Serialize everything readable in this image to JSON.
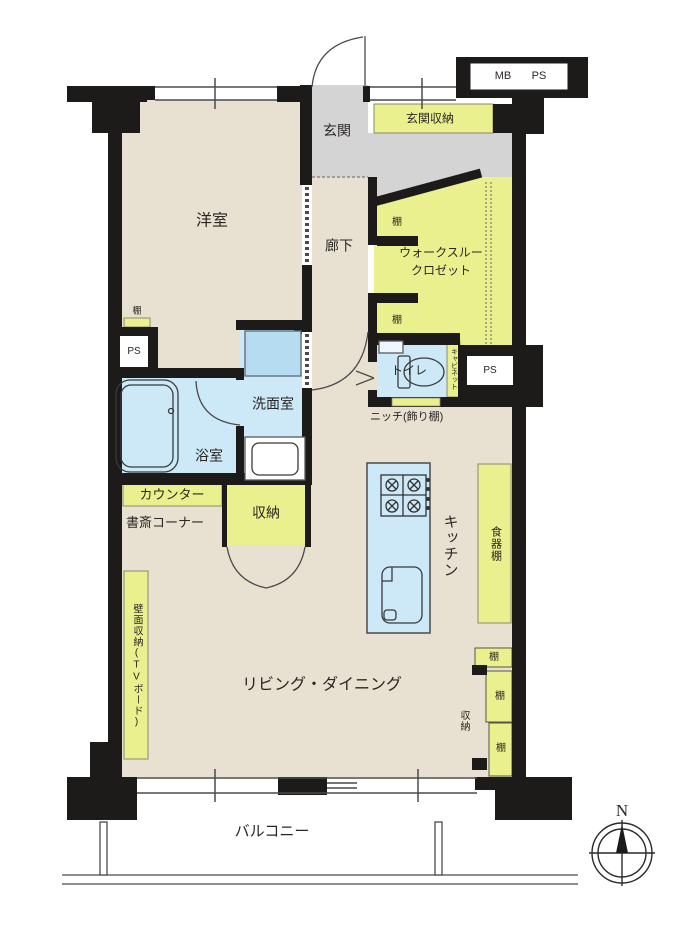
{
  "plan": {
    "rooms": {
      "western_room": "洋室",
      "entrance": "玄関",
      "hallway": "廊下",
      "walk_through_closet": [
        "ウォークスルー",
        "クロゼット"
      ],
      "toilet": "トイレ",
      "washroom": "洗面室",
      "bathroom": "浴室",
      "kitchen": "キッチン",
      "living_dining": "リビング・ダイニング",
      "balcony": "バルコニー"
    },
    "storage": {
      "entrance_storage": "玄関収納",
      "shelf": "棚",
      "cabinet": "キャビネット",
      "niche": "ニッチ(飾り棚)",
      "counter": "カウンター",
      "study_corner": "書斎コーナー",
      "storage": "収納",
      "dish_cabinet": "食器棚",
      "wall_storage_tv_board": "壁面収納(TVボード)"
    },
    "utility": {
      "mb": "MB",
      "ps": "PS"
    },
    "compass": {
      "north": "N"
    },
    "colors": {
      "floor": "#e8e1d1",
      "entrance_floor": "#d4d4d5",
      "storage_fill": "#eaf08d",
      "water_fill": "#cde9f7",
      "vanity_fill": "#b5dcf0",
      "wall": "#1d1a1a"
    }
  }
}
